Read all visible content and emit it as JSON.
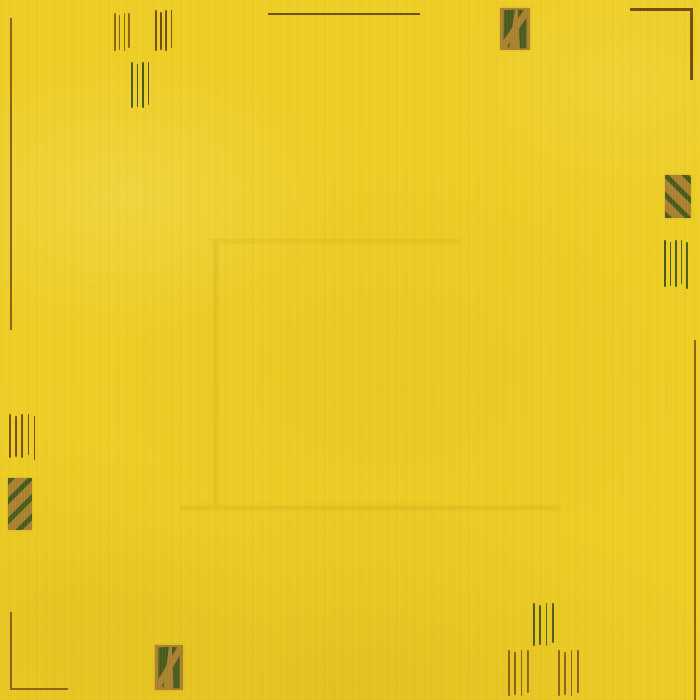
{
  "scene": {
    "description": "Close-up photograph of a plain bright-yellow hand-knotted wool rug with sparse minimalist border ornaments: small groups of short vertical pin-stripes, thin corner L-lines, and four small gold rectangles bearing dark-green diagonal motifs. A faint horizontal fold crease crosses the lower middle of the rug.",
    "background_color": "#f0cf24"
  },
  "palette": {
    "yellow": "#f0cf24",
    "gold": "#aa812f",
    "green": "#465a1d",
    "brown": "#8a6414",
    "darkbrown": "#6f4c10",
    "crease": "rgba(120,92,0,0.16)"
  },
  "motifs": [
    {
      "name": "left-edge-border-line",
      "type": "vline",
      "x": 10,
      "y": 18,
      "length": 312,
      "thickness": 2,
      "color": "brown"
    },
    {
      "name": "top-left-line-group-a",
      "type": "vlines",
      "x": 114,
      "y": 13,
      "height": 38,
      "count": 4,
      "gap": 4.8,
      "thickness": 1.6,
      "color": "brown"
    },
    {
      "name": "top-left-line-group-b",
      "type": "vlines",
      "x": 155,
      "y": 10,
      "height": 41,
      "count": 4,
      "gap": 5.2,
      "thickness": 1.6,
      "color": "darkbrown"
    },
    {
      "name": "top-left-line-group-c",
      "type": "vlines",
      "x": 131,
      "y": 62,
      "height": 46,
      "count": 4,
      "gap": 5.5,
      "thickness": 1.6,
      "color": "green"
    },
    {
      "name": "top-border-line",
      "type": "hline",
      "x": 268,
      "y": 13,
      "length": 152,
      "thickness": 2,
      "color": "darkbrown"
    },
    {
      "name": "top-right-patch",
      "type": "patch",
      "variant": "blocky",
      "x": 500,
      "y": 8,
      "w": 30,
      "h": 42
    },
    {
      "name": "top-right-corner-hline",
      "type": "hline",
      "x": 630,
      "y": 8,
      "length": 62,
      "thickness": 2.5,
      "color": "darkbrown"
    },
    {
      "name": "top-right-corner-vline",
      "type": "vline",
      "x": 690,
      "y": 8,
      "length": 72,
      "thickness": 2.5,
      "color": "darkbrown"
    },
    {
      "name": "right-patch",
      "type": "patch",
      "variant": "stripes-down",
      "x": 665,
      "y": 175,
      "w": 26,
      "h": 43
    },
    {
      "name": "right-line-group",
      "type": "vlines",
      "x": 664,
      "y": 240,
      "height": 47,
      "count": 5,
      "gap": 5.6,
      "thickness": 1.6,
      "color": "green"
    },
    {
      "name": "right-edge-border-line",
      "type": "vline",
      "x": 694,
      "y": 340,
      "length": 360,
      "thickness": 2,
      "color": "brown"
    },
    {
      "name": "left-line-group",
      "type": "vlines",
      "x": 9,
      "y": 414,
      "height": 44,
      "count": 5,
      "gap": 6.2,
      "thickness": 1.6,
      "color": "darkbrown"
    },
    {
      "name": "left-patch",
      "type": "patch",
      "variant": "stripes-up",
      "x": 8,
      "y": 478,
      "w": 24,
      "h": 52
    },
    {
      "name": "bottom-left-corner-vline",
      "type": "vline",
      "x": 10,
      "y": 612,
      "length": 78,
      "thickness": 2,
      "color": "brown"
    },
    {
      "name": "bottom-left-corner-hline",
      "type": "hline",
      "x": 10,
      "y": 688,
      "length": 58,
      "thickness": 2,
      "color": "brown"
    },
    {
      "name": "bottom-center-patch",
      "type": "patch",
      "variant": "blocky",
      "x": 155,
      "y": 645,
      "w": 28,
      "h": 45
    },
    {
      "name": "bottom-line-group-upper",
      "type": "vlines",
      "x": 533,
      "y": 603,
      "height": 43,
      "count": 4,
      "gap": 6.4,
      "thickness": 1.7,
      "color": "green"
    },
    {
      "name": "bottom-line-group-left",
      "type": "vlines",
      "x": 508,
      "y": 650,
      "height": 46,
      "count": 4,
      "gap": 6.4,
      "thickness": 1.7,
      "color": "brown"
    },
    {
      "name": "bottom-line-group-right",
      "type": "vlines",
      "x": 558,
      "y": 650,
      "height": 46,
      "count": 4,
      "gap": 6.4,
      "thickness": 1.7,
      "color": "brown"
    }
  ],
  "creases": [
    {
      "name": "fold-crease-horizontal",
      "orient": "h",
      "x": 180,
      "y": 506,
      "length": 380,
      "thickness": 3
    },
    {
      "name": "fold-crease-left",
      "orient": "v",
      "x": 214,
      "y": 242,
      "length": 262,
      "thickness": 3
    },
    {
      "name": "fold-crease-top",
      "orient": "h",
      "x": 210,
      "y": 240,
      "length": 250,
      "thickness": 2
    }
  ]
}
